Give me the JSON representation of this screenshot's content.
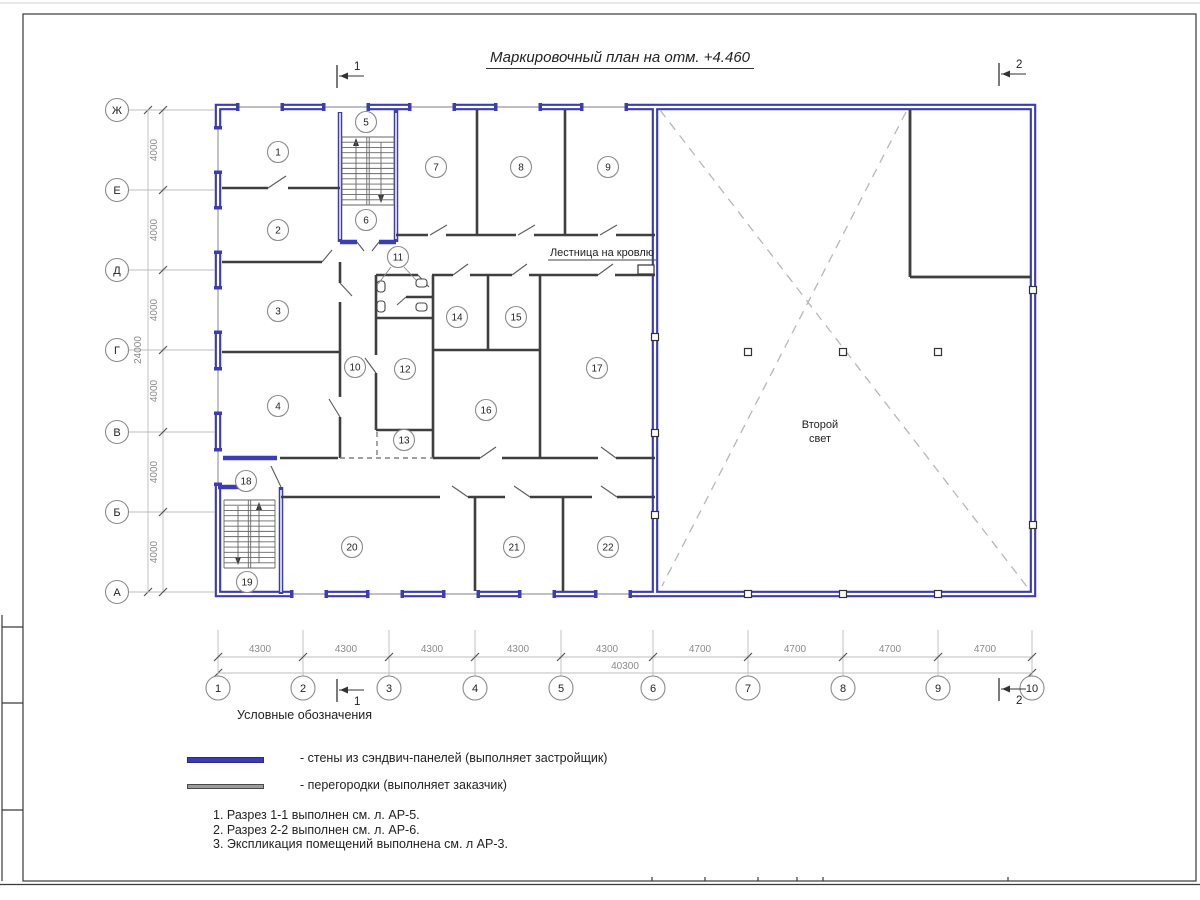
{
  "sheet": {
    "title": "Маркировочный план на отм. +4.460"
  },
  "plan_labels": {
    "stairs_to_roof": "Лестница на кровлю",
    "second_light": [
      "Второй",
      "свет"
    ]
  },
  "rooms": [
    {
      "n": "1",
      "x": 278,
      "y": 152
    },
    {
      "n": "2",
      "x": 278,
      "y": 230
    },
    {
      "n": "3",
      "x": 278,
      "y": 311
    },
    {
      "n": "4",
      "x": 278,
      "y": 406
    },
    {
      "n": "5",
      "x": 366,
      "y": 122
    },
    {
      "n": "6",
      "x": 366,
      "y": 220
    },
    {
      "n": "7",
      "x": 436,
      "y": 167
    },
    {
      "n": "8",
      "x": 521,
      "y": 167
    },
    {
      "n": "9",
      "x": 608,
      "y": 167
    },
    {
      "n": "10",
      "x": 355,
      "y": 367
    },
    {
      "n": "11",
      "x": 398,
      "y": 257
    },
    {
      "n": "12",
      "x": 405,
      "y": 369
    },
    {
      "n": "13",
      "x": 404,
      "y": 440
    },
    {
      "n": "14",
      "x": 457,
      "y": 317
    },
    {
      "n": "15",
      "x": 516,
      "y": 317
    },
    {
      "n": "16",
      "x": 486,
      "y": 410
    },
    {
      "n": "17",
      "x": 597,
      "y": 368
    },
    {
      "n": "18",
      "x": 246,
      "y": 481
    },
    {
      "n": "19",
      "x": 247,
      "y": 582
    },
    {
      "n": "20",
      "x": 352,
      "y": 547
    },
    {
      "n": "21",
      "x": 514,
      "y": 547
    },
    {
      "n": "22",
      "x": 608,
      "y": 547
    }
  ],
  "axes": {
    "rows": [
      {
        "label": "Ж",
        "y": 110
      },
      {
        "label": "Е",
        "y": 190
      },
      {
        "label": "Д",
        "y": 270
      },
      {
        "label": "Г",
        "y": 350
      },
      {
        "label": "В",
        "y": 432
      },
      {
        "label": "Б",
        "y": 512
      },
      {
        "label": "А",
        "y": 592
      }
    ],
    "cols": [
      {
        "label": "1",
        "x": 218
      },
      {
        "label": "2",
        "x": 303
      },
      {
        "label": "3",
        "x": 389
      },
      {
        "label": "4",
        "x": 475
      },
      {
        "label": "5",
        "x": 561
      },
      {
        "label": "6",
        "x": 653
      },
      {
        "label": "7",
        "x": 748
      },
      {
        "label": "8",
        "x": 843
      },
      {
        "label": "9",
        "x": 938
      },
      {
        "label": "10",
        "x": 1032
      }
    ]
  },
  "dimensions": {
    "row_segments": [
      {
        "text": "4000",
        "y": 150
      },
      {
        "text": "4000",
        "y": 230
      },
      {
        "text": "4000",
        "y": 310
      },
      {
        "text": "4000",
        "y": 391
      },
      {
        "text": "4000",
        "y": 472
      },
      {
        "text": "4000",
        "y": 552
      }
    ],
    "row_total": {
      "text": "24000",
      "y": 350
    },
    "col_segments": [
      {
        "text": "4300",
        "x": 260
      },
      {
        "text": "4300",
        "x": 346
      },
      {
        "text": "4300",
        "x": 432
      },
      {
        "text": "4300",
        "x": 518
      },
      {
        "text": "4300",
        "x": 607
      },
      {
        "text": "4700",
        "x": 700
      },
      {
        "text": "4700",
        "x": 795
      },
      {
        "text": "4700",
        "x": 890
      },
      {
        "text": "4700",
        "x": 985
      }
    ],
    "col_total": {
      "text": "40300",
      "x": 625
    }
  },
  "section_marks": [
    {
      "label": "1",
      "x": 337,
      "ym": 76,
      "pos": "top"
    },
    {
      "label": "2",
      "x": 999,
      "ym": 74,
      "pos": "top"
    },
    {
      "label": "1",
      "x": 337,
      "ym": 690,
      "pos": "bottom"
    },
    {
      "label": "2",
      "x": 999,
      "ym": 689,
      "pos": "bottom"
    }
  ],
  "legend": {
    "heading": "Условные обозначения",
    "items": [
      {
        "swatch": "sandwich-wall",
        "label": "- стены из сэндвич-панелей (выполняет застройщик)"
      },
      {
        "swatch": "partition",
        "label": "- перегородки (выполняет заказчик)"
      }
    ]
  },
  "notes": [
    "1. Разрез 1-1 выполнен см. л. АР-5.",
    "2. Разрез 2-2 выполнен см. л. АР-6.",
    "3. Экспликация помещений выполнена см. л АР-3."
  ],
  "colors": {
    "wall_blue": "#3c3cb4",
    "partition_ink": "#3f3f3f",
    "legend_partition_gray": "#9c9c9c",
    "dim_gray": "#8a8a8a"
  }
}
